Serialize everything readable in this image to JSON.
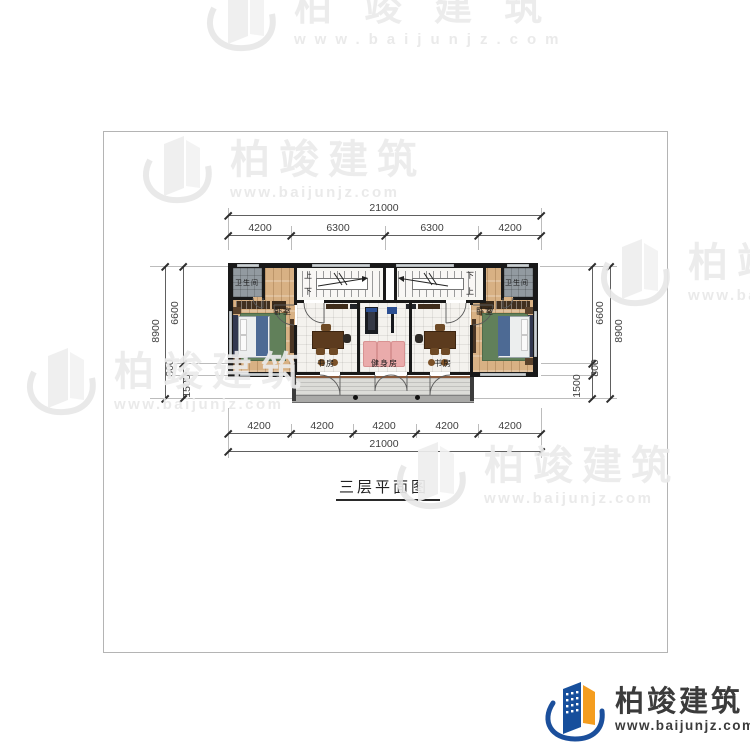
{
  "watermark": {
    "brand": "柏竣建筑",
    "url": "www.baijunjz.com"
  },
  "logo": {
    "brand": "柏竣建筑",
    "url": "www.baijunjz.com"
  },
  "title": "三层平面图",
  "dims": {
    "top": {
      "total": "21000",
      "segments": [
        "4200",
        "6300",
        "6300",
        "4200"
      ]
    },
    "bottom": {
      "total": "21000",
      "segments": [
        "4200",
        "4200",
        "4200",
        "4200",
        "4200"
      ]
    },
    "left": {
      "total": "8900",
      "segments": [
        "6600",
        "800",
        "1500"
      ]
    },
    "right": {
      "total": "8900",
      "segments": [
        "6600",
        "800",
        "1500"
      ]
    }
  },
  "rooms": {
    "bathroom_left": "卫生间",
    "bathroom_right": "卫生间",
    "bedroom_left": "卧室",
    "bedroom_right": "卧室",
    "study_left": "书房",
    "study_right": "书房",
    "gym": "健身房",
    "stair_up": "上",
    "stair_down": "下"
  }
}
